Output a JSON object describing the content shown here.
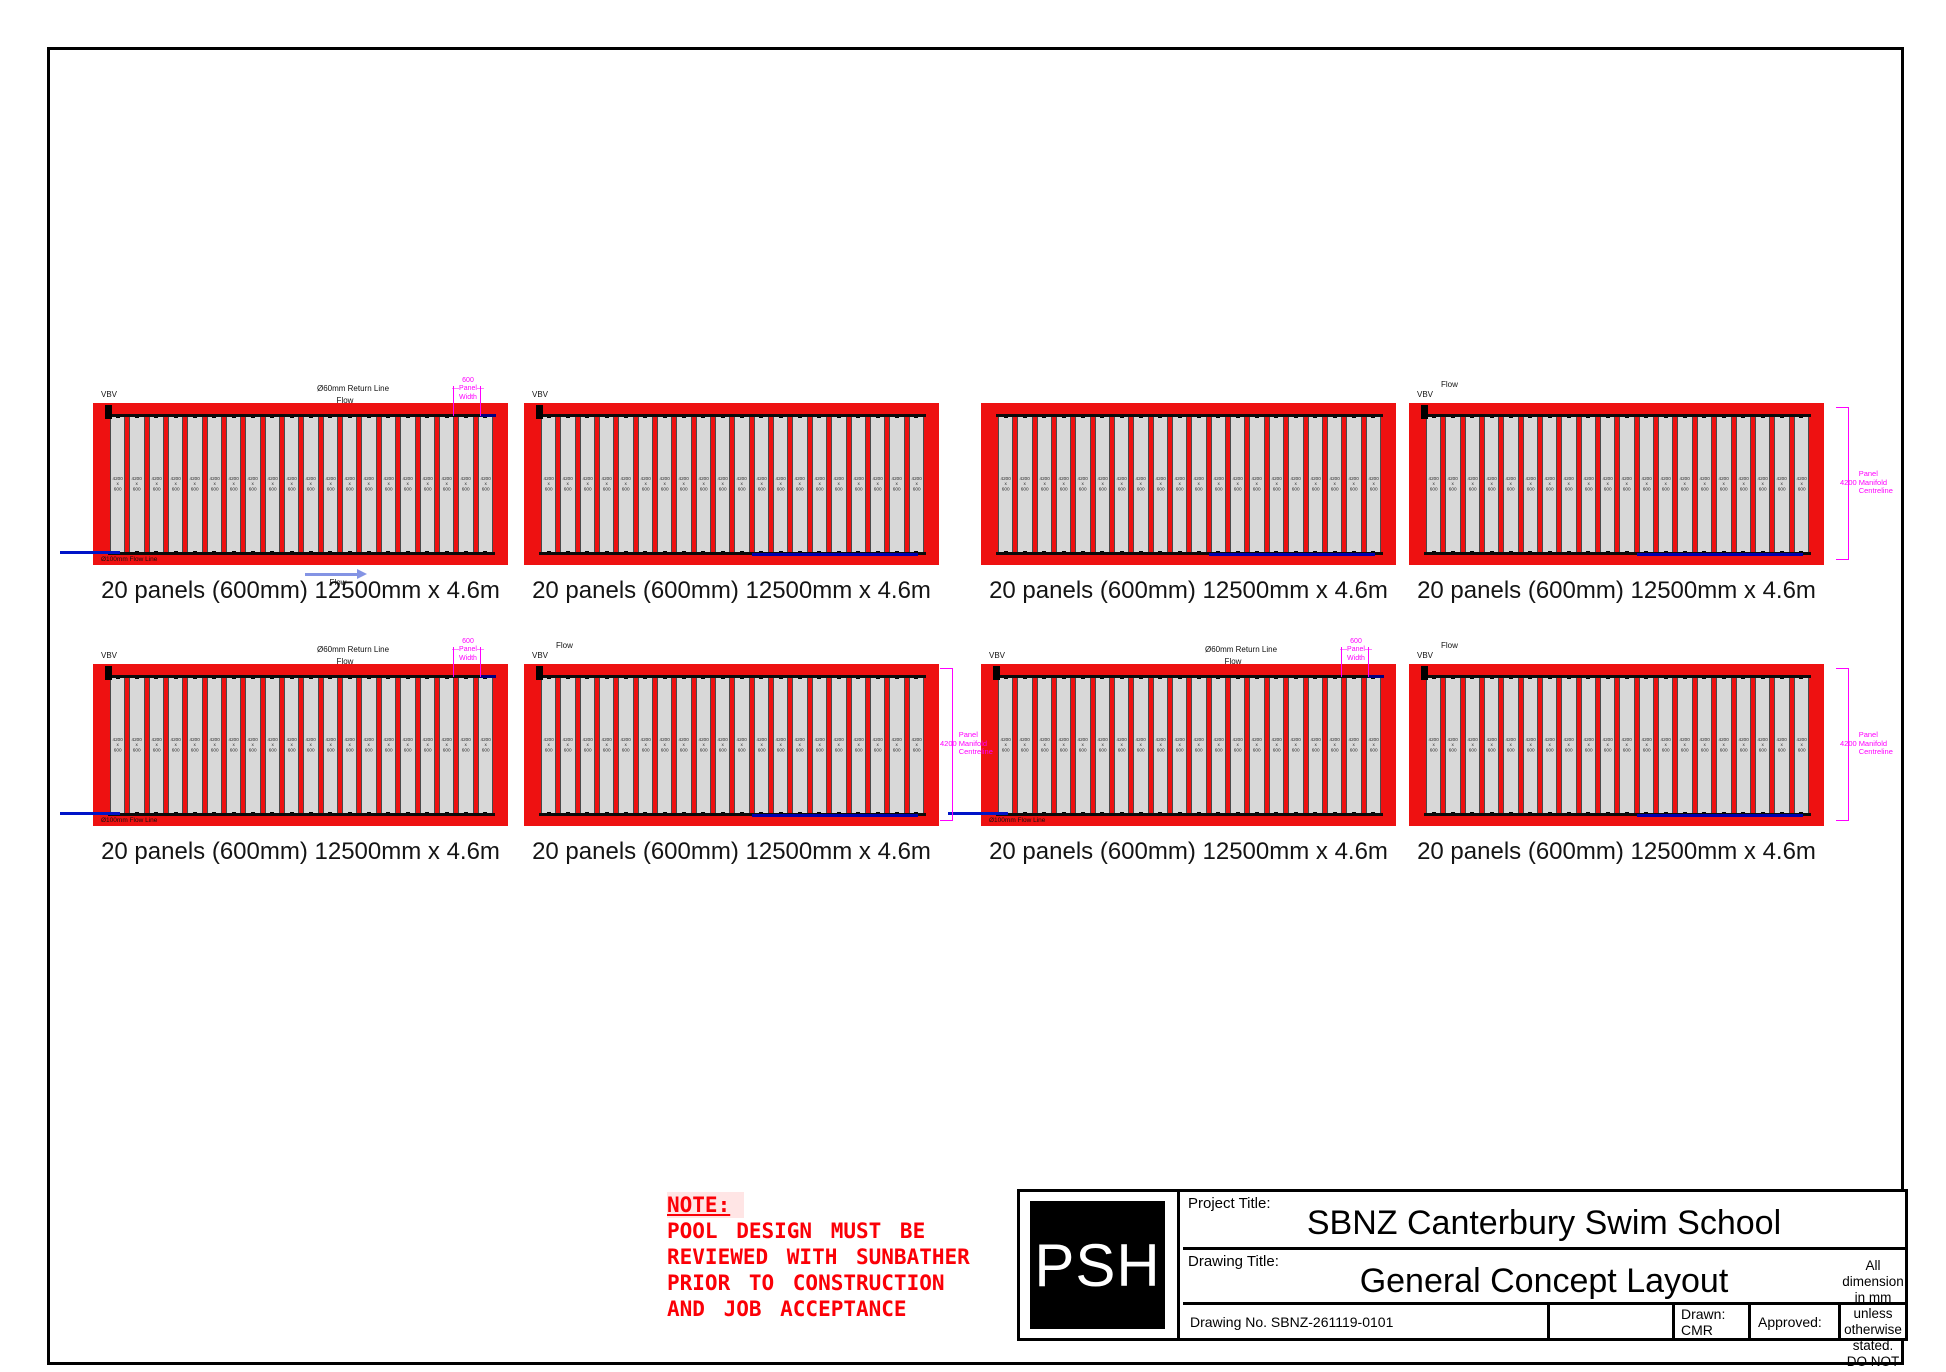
{
  "sheet": {
    "width": 1946,
    "height": 1372
  },
  "colors": {
    "array_red": "#ee1111",
    "panel_gray": "#d8d8d8",
    "magenta": "#ff00ff",
    "flow_navy": "#0000ae",
    "flow_blue": "#0014c8",
    "arrow_blue": "#8494e4",
    "note_red": "#fb0007"
  },
  "labels": {
    "vbv": "VBV",
    "return_line": "Ø60mm Return Line",
    "flow": "Flow",
    "flow_line": "Ø100mm Flow Line",
    "panel_width": {
      "value": "600",
      "mid": "Panel",
      "bottom": "Width"
    },
    "manifold_dim": {
      "value": "4200",
      "lines": [
        "Panel",
        "Manifold",
        "Centreline"
      ]
    }
  },
  "panel_label": {
    "lines": [
      "4200",
      "x",
      "600"
    ]
  },
  "panels_per_array": 20,
  "arrays": [
    {
      "x": 93,
      "y": 403,
      "w": 415,
      "h": 162,
      "caption": "20 panels (600mm) 12500mm x 4.6m",
      "vbv": true,
      "return_line": true,
      "panel_width": true,
      "flow_left": true,
      "flow_line_label": true,
      "flow_arrow": true,
      "blue_bottom": false,
      "flow_top": false,
      "manifold_dim": null
    },
    {
      "x": 524,
      "y": 403,
      "w": 415,
      "h": 162,
      "caption": "20 panels (600mm) 12500mm x 4.6m",
      "vbv": true,
      "return_line": false,
      "panel_width": false,
      "flow_left": false,
      "flow_line_label": false,
      "flow_arrow": false,
      "blue_bottom": true,
      "flow_top": false,
      "manifold_dim": null
    },
    {
      "x": 981,
      "y": 403,
      "w": 415,
      "h": 162,
      "caption": "20 panels (600mm) 12500mm x 4.6m",
      "vbv": false,
      "return_line": false,
      "panel_width": false,
      "flow_left": false,
      "flow_line_label": false,
      "flow_arrow": false,
      "blue_bottom": true,
      "flow_top": false,
      "manifold_dim": null
    },
    {
      "x": 1409,
      "y": 403,
      "w": 415,
      "h": 162,
      "caption": "20 panels (600mm) 12500mm x 4.6m",
      "vbv": true,
      "return_line": false,
      "panel_width": false,
      "flow_left": false,
      "flow_line_label": false,
      "flow_arrow": false,
      "blue_bottom": true,
      "flow_top": true,
      "manifold_dim": "outside"
    },
    {
      "x": 93,
      "y": 664,
      "w": 415,
      "h": 162,
      "caption": "20 panels (600mm) 12500mm x 4.6m",
      "vbv": true,
      "return_line": true,
      "panel_width": true,
      "flow_left": true,
      "flow_line_label": true,
      "flow_arrow": false,
      "blue_bottom": false,
      "flow_top": false,
      "manifold_dim": null
    },
    {
      "x": 524,
      "y": 664,
      "w": 415,
      "h": 162,
      "caption": "20 panels (600mm) 12500mm x 4.6m",
      "vbv": true,
      "return_line": false,
      "panel_width": false,
      "flow_left": false,
      "flow_line_label": false,
      "flow_arrow": false,
      "blue_bottom": true,
      "flow_top": true,
      "manifold_dim": "overlap"
    },
    {
      "x": 981,
      "y": 664,
      "w": 415,
      "h": 162,
      "caption": "20 panels (600mm) 12500mm x 4.6m",
      "vbv": true,
      "return_line": true,
      "panel_width": true,
      "flow_left": true,
      "flow_line_label": true,
      "flow_arrow": false,
      "blue_bottom": false,
      "flow_top": false,
      "manifold_dim": null
    },
    {
      "x": 1409,
      "y": 664,
      "w": 415,
      "h": 162,
      "caption": "20 panels (600mm) 12500mm x 4.6m",
      "vbv": true,
      "return_line": false,
      "panel_width": false,
      "flow_left": false,
      "flow_line_label": false,
      "flow_arrow": false,
      "blue_bottom": true,
      "flow_top": true,
      "manifold_dim": "outside"
    }
  ],
  "note": {
    "title": "NOTE:",
    "lines": [
      "POOL DESIGN MUST BE",
      "REVIEWED WITH SUNBATHER",
      "PRIOR TO CONSTRUCTION",
      "AND JOB ACCEPTANCE"
    ]
  },
  "title_block": {
    "logo": "PSH",
    "project_title_label": "Project Title:",
    "project_title": "SBNZ Canterbury Swim School",
    "drawing_title_label": "Drawing Title:",
    "drawing_title": "General Concept Layout",
    "drawing_no": "Drawing No. SBNZ-261119-0101",
    "drawn": "Drawn: CMR",
    "approved": "Approved:",
    "dimension_note_line1": "All dimension in mm unless",
    "dimension_note_line2": "otherwise stated.  DO NOT SCALE."
  }
}
